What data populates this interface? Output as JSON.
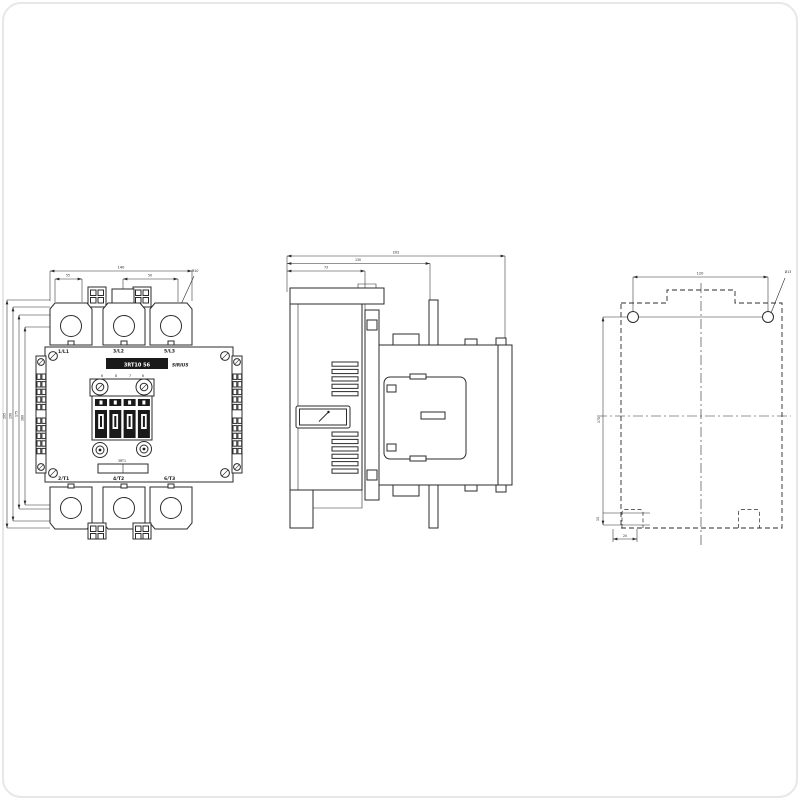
{
  "drawing": {
    "type_label": "3RT10 56",
    "brand": "SIRIUS",
    "coil_label": "3RT1",
    "front": {
      "terminals_top": [
        "1/L1",
        "3/L2",
        "5/L3"
      ],
      "terminals_bottom": [
        "2/T1",
        "4/T2",
        "6/T3"
      ],
      "coil_terminals": [
        "6",
        "8",
        "7",
        "6"
      ],
      "dims": {
        "width_total": "140",
        "width_left": "55",
        "width_right": "50",
        "hole_leader": "M10",
        "height_total": "205",
        "height_housing": "190",
        "height_outer": "175",
        "hole_pitch": "160"
      }
    },
    "side": {
      "dims": {
        "depth_total": "202",
        "depth_front": "130",
        "depth_min": "73"
      }
    },
    "rear": {
      "dims": {
        "hole_spacing": "120",
        "hole_dia": "Ø13",
        "mount_height": "170",
        "notch_offset": "15",
        "notch_width": "20"
      }
    }
  },
  "colors": {
    "line": "#2b2b2b",
    "label_bg": "#111111",
    "label_text": "#ffffff",
    "background": "#ffffff"
  }
}
